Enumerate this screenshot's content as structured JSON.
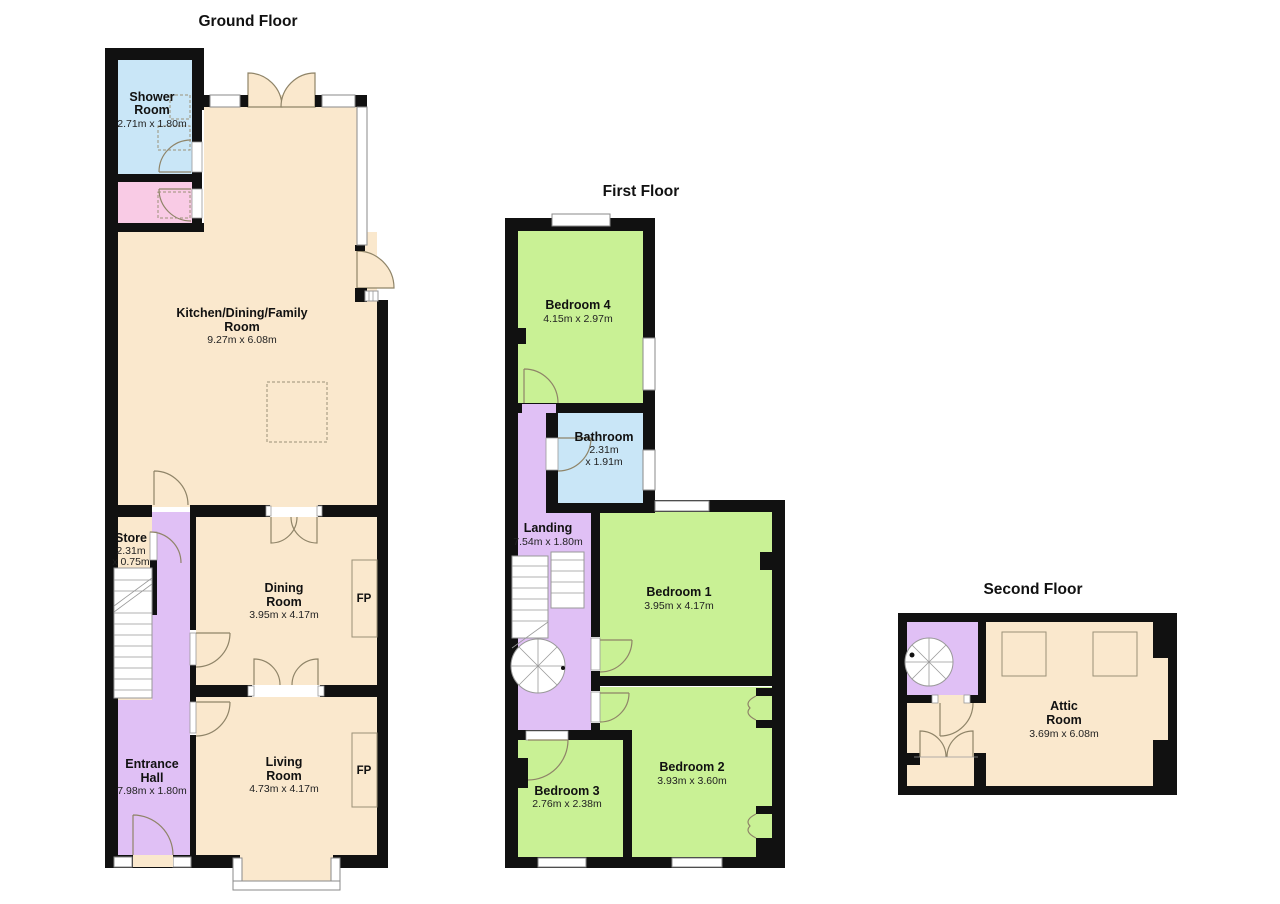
{
  "page": {
    "background": "#FFFFFF"
  },
  "palette": {
    "wall": "#111111",
    "cream": "#FAE8CD",
    "green": "#C9F195",
    "purple": "#E0C0F5",
    "blue": "#C9E6F7",
    "pink": "#F9CBE5",
    "thin_line": "#8F8468",
    "window_fill": "#FFFFFF"
  },
  "floors": {
    "ground": {
      "title": "Ground Floor",
      "fireplace_label": "FP",
      "rooms": {
        "shower": {
          "line1": "Shower",
          "line2": "Room",
          "dims": "2.71m x 1.80m"
        },
        "kitchen": {
          "line1": "Kitchen/Dining/Family",
          "line2": "Room",
          "dims": "9.27m x 6.08m"
        },
        "store": {
          "line1": "Store",
          "dims1": "2.31m",
          "dims2": "x 0.75m"
        },
        "dining": {
          "line1": "Dining",
          "line2": "Room",
          "dims": "3.95m x 4.17m"
        },
        "living": {
          "line1": "Living",
          "line2": "Room",
          "dims": "4.73m x 4.17m"
        },
        "hall": {
          "line1": "Entrance",
          "line2": "Hall",
          "dims": "7.98m x 1.80m"
        }
      }
    },
    "first": {
      "title": "First Floor",
      "rooms": {
        "bedroom4": {
          "line1": "Bedroom 4",
          "dims": "4.15m x 2.97m"
        },
        "bathroom": {
          "line1": "Bathroom",
          "dims1": "2.31m",
          "dims2": "x 1.91m"
        },
        "landing": {
          "line1": "Landing",
          "dims": "7.54m x 1.80m"
        },
        "bedroom1": {
          "line1": "Bedroom 1",
          "dims": "3.95m x 4.17m"
        },
        "bedroom2": {
          "line1": "Bedroom 2",
          "dims": "3.93m x 3.60m"
        },
        "bedroom3": {
          "line1": "Bedroom 3",
          "dims": "2.76m x 2.38m"
        }
      }
    },
    "second": {
      "title": "Second Floor",
      "rooms": {
        "attic": {
          "line1": "Attic",
          "line2": "Room",
          "dims": "3.69m x 6.08m"
        }
      }
    }
  }
}
